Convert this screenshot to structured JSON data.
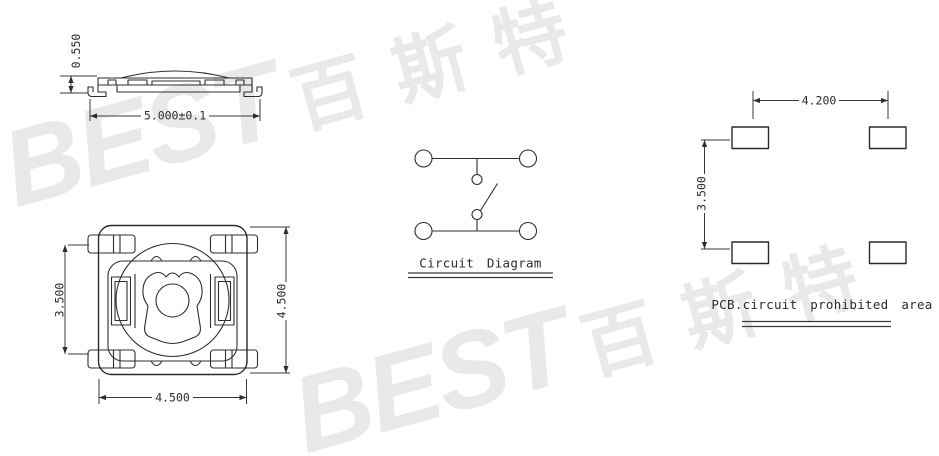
{
  "canvas": {
    "width": 939,
    "height": 456,
    "background_color": "#ffffff",
    "line_color": "#2f2f2f",
    "watermark_color": "#e9e9e9"
  },
  "side_view": {
    "dim_height": "0.550",
    "dim_width": "5.000±0.1"
  },
  "top_view": {
    "dim_lead_pitch": "3.500",
    "dim_height": "4.500",
    "dim_width": "4.500"
  },
  "circuit_diagram": {
    "caption": "Circuit Diagram"
  },
  "pcb_layout": {
    "dim_pad_pitch_x": "4.200",
    "dim_pad_pitch_y": "3.500",
    "caption": "PCB.circuit prohibited area"
  },
  "watermark": {
    "latin": "BEST",
    "cjk": [
      "百",
      "斯",
      "特"
    ]
  }
}
